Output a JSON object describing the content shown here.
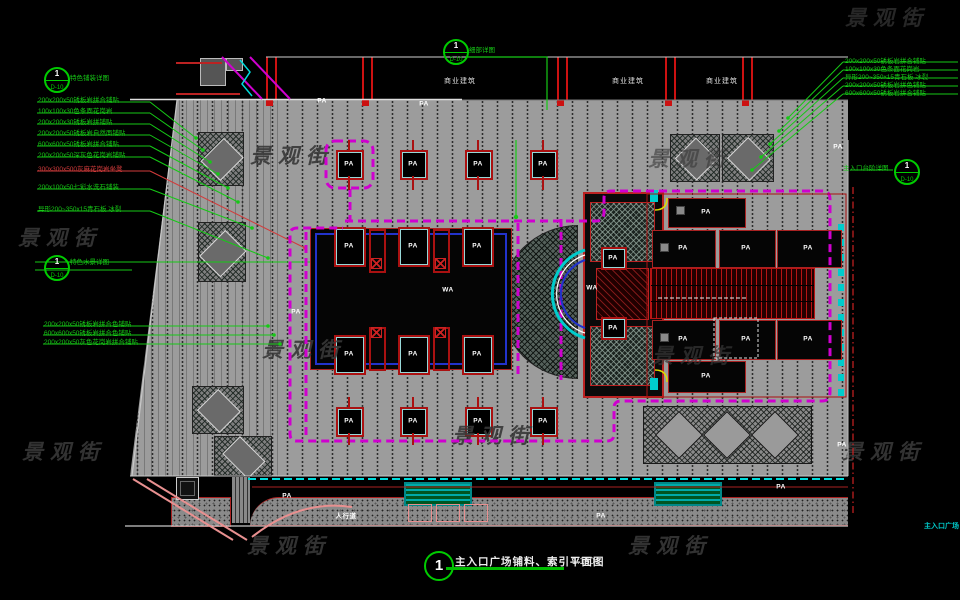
{
  "watermark": {
    "text": "景观街",
    "color": "#383838"
  },
  "labels": {
    "pa": "PA",
    "wa": "WA",
    "sidewalk": "人行道",
    "corner": "主入口广场"
  },
  "title_block": {
    "number": "1",
    "title": "主入口广场铺料、索引平面图",
    "scale": "1:150"
  },
  "top_band": {
    "building_labels": [
      "商业建筑",
      "商业建筑",
      "商业建筑"
    ]
  },
  "detail_markers": {
    "top_left": {
      "number": "1",
      "sheet": "D-10",
      "label": "特色铺装详图"
    },
    "top_center": {
      "number": "1",
      "sheet": "D-10",
      "label": "细部详图"
    },
    "left_mid": {
      "number": "1",
      "sheet": "D-10",
      "label": "特色水景详图"
    },
    "right": {
      "number": "1",
      "sheet": "D-10",
      "label": "主入口台阶详图"
    }
  },
  "left_annotations": {
    "group1": [
      {
        "text": "200x200x50锈板岩拼合铺贴",
        "color": "green"
      },
      {
        "text": "100x100x30色条面花岗岩",
        "color": "green"
      },
      {
        "text": "200x200x30锈板岩拼铺贴",
        "color": "green"
      },
      {
        "text": "200x200x50锈板岩自然面铺贴",
        "color": "green"
      },
      {
        "text": "600x600x50锈板岩拼合铺贴",
        "color": "green"
      },
      {
        "text": "200x200x50深灰色花岗岩铺贴",
        "color": "green"
      },
      {
        "text": "300x300x500灰麻花岗岩坐凳",
        "color": "red"
      },
      {
        "text": "200x100x50七彩水洗石铺装",
        "color": "green"
      },
      {
        "text": "异形200~350x15青石板 冰裂",
        "color": "green"
      }
    ],
    "group2": [
      {
        "text": "200x200x50锈板岩拼合色铺贴"
      },
      {
        "text": "600x600x50锈板岩拼合色铺贴"
      },
      {
        "text": "200x200x50灰色花岗岩拼合铺贴"
      }
    ]
  },
  "right_annotations": [
    {
      "text": "200x200x50锈板岩拼合铺贴"
    },
    {
      "text": "100x100x30色条面花岗岩"
    },
    {
      "text": "异形200~350x15青石板 冰裂"
    },
    {
      "text": "200x200x50锈板岩拼色铺贴"
    },
    {
      "text": "600x600x50锈板岩拼合铺贴"
    }
  ],
  "colors": {
    "background": "#000000",
    "paving_gray": "#9c9c9c",
    "annotation_green": "#16c916",
    "index_magenta": "#cf00cf",
    "cyan": "#00dcdc",
    "cad_red": "#bb1111",
    "pool_blue": "#2233cc",
    "watermark_gray": "#383838",
    "bench_teal": "#008888",
    "furniture_pink": "#e89090",
    "door_yellow": "#dddd00"
  }
}
